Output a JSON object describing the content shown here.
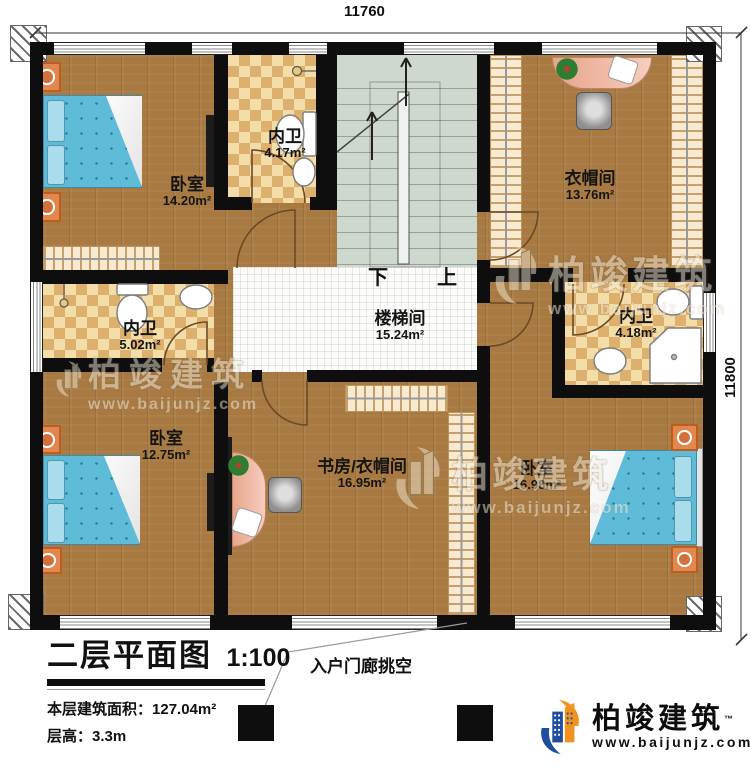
{
  "plan": {
    "title": "二层平面图",
    "scale": "1:100",
    "stats": [
      {
        "label": "本层建筑面积：",
        "value": "127.04m²"
      },
      {
        "label": "层高：",
        "value": "3.3m"
      }
    ],
    "porch_label": "入户门廊挑空",
    "dims": {
      "top": "11760",
      "right": "11800"
    },
    "stairs": {
      "down": "下",
      "up": "上"
    }
  },
  "rooms": [
    {
      "id": "bedroom-top-left",
      "name": "卧室",
      "area": "14.20m²"
    },
    {
      "id": "bath-top",
      "name": "内卫",
      "area": "4.17m²"
    },
    {
      "id": "cloakroom",
      "name": "衣帽间",
      "area": "13.76m²"
    },
    {
      "id": "bath-left",
      "name": "内卫",
      "area": "5.02m²"
    },
    {
      "id": "stair-hall",
      "name": "楼梯间",
      "area": "15.24m²"
    },
    {
      "id": "bath-right",
      "name": "内卫",
      "area": "4.18m²"
    },
    {
      "id": "bedroom-bottom-left",
      "name": "卧室",
      "area": "12.75m²"
    },
    {
      "id": "study-cloakroom",
      "name": "书房/衣帽间",
      "area": "16.95m²"
    },
    {
      "id": "bedroom-bottom-right",
      "name": "卧室",
      "area": "16.98m²"
    }
  ],
  "watermark": {
    "brand": "柏竣建筑",
    "url": "www.baijunjz.com"
  },
  "logo": {
    "brand": "柏竣建筑",
    "tm": "™",
    "url": "www.baijunjz.com"
  }
}
